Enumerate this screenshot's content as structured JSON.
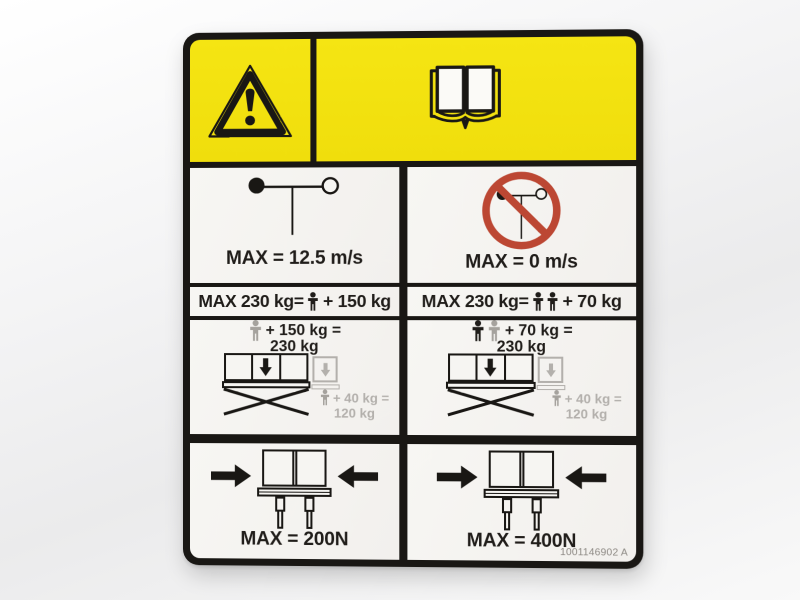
{
  "decal": {
    "wind_allowed": {
      "caption": "MAX = 12.5 m/s"
    },
    "wind_prohibited": {
      "caption": "MAX = 0 m/s"
    },
    "capacity_left": {
      "prefix": "MAX 230 kg=",
      "suffix": "+ 150 kg"
    },
    "capacity_right": {
      "prefix": "MAX 230 kg=",
      "suffix": "+ 70 kg"
    },
    "load_left": {
      "line1": "+ 150 kg =",
      "line2": "230 kg",
      "ext1": "+ 40 kg =",
      "ext2": "120 kg"
    },
    "load_right": {
      "line1": "+ 70 kg =",
      "line2": "230 kg",
      "ext1": "+ 40 kg =",
      "ext2": "120 kg"
    },
    "force_left": {
      "caption": "MAX = 200N"
    },
    "force_right": {
      "caption": "MAX = 400N"
    },
    "part_number": "1001146902 A",
    "icons": {
      "header_left": "warning-triangle-icon",
      "header_right": "read-operators-manual-book-icon",
      "wind": "anemometer-icon",
      "no_wind": "no-wind-prohibition-icon"
    },
    "colors": {
      "yellow": "#f0de0c",
      "red": "#bc4733",
      "black": "#191714",
      "cell": "#f2f0ed",
      "gray": "#b3b0ac"
    }
  }
}
